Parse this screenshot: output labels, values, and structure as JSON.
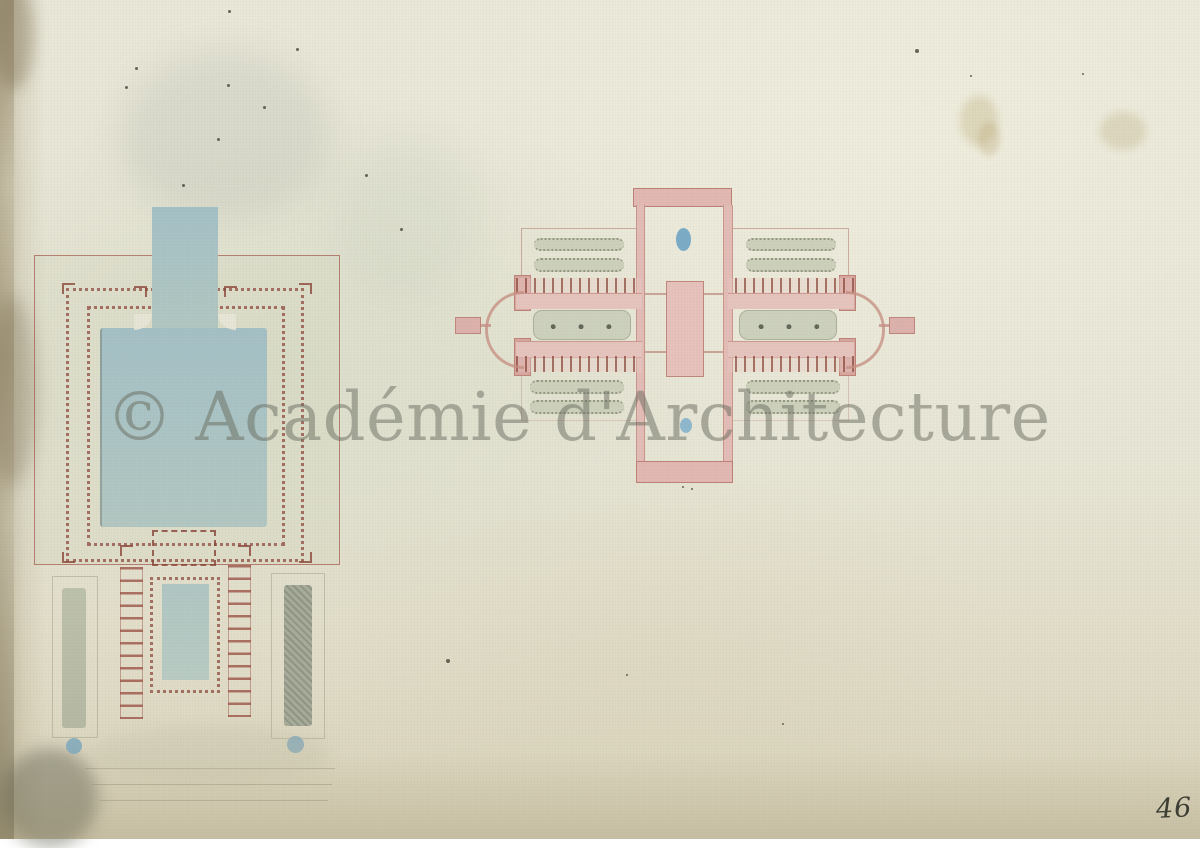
{
  "artwork": {
    "watermark": "© Académie d'Architecture",
    "page_number": "46",
    "colors": {
      "paper": "#e7e5d6",
      "paper_edge_brown": "#948562",
      "ink_red_outline": "#a4574a",
      "dot_red": "#8c463a",
      "wash_pink": "#e2b8b2",
      "wash_blue_water": "#a9c2c4",
      "wash_green_grey": "#ccd1bd",
      "accent_blue_dot": "#6ea4c4",
      "watermark_grey": "#696c60",
      "folio_ink": "#3c3d33"
    }
  }
}
